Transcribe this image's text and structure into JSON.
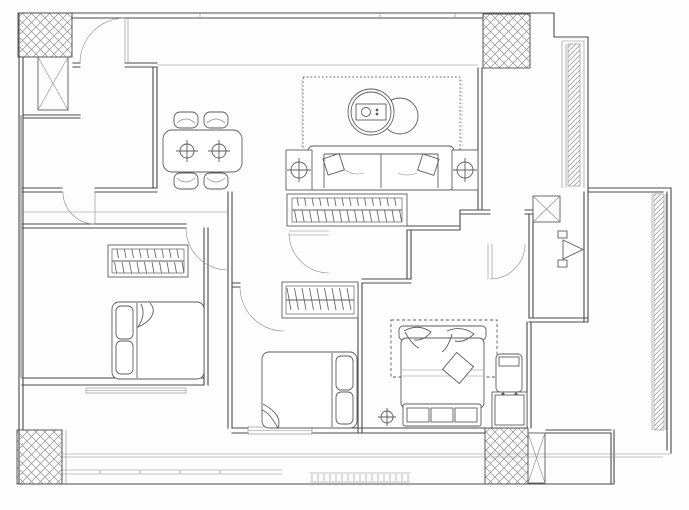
{
  "page": {
    "title": "Apartment Floor Plan (CAD line drawing)",
    "background": "#fdfdfd"
  },
  "colors": {
    "wall": "#4a4a4a",
    "thin": "#8b8b8b",
    "furn": "#5c5c5c",
    "hatch": "#909090",
    "bg": "#fdfdfd"
  },
  "elements": {
    "plan": {
      "label": "two-bedroom apartment floor plan, black line CAD drawing on white"
    },
    "structure": {
      "columns": {
        "label": "cross-hatched structural columns at four corners"
      },
      "shafts": {
        "label": "X-braced duct and shaft boxes"
      },
      "glass_strips": {
        "label": "diagonally hatched balcony parapet strips on right side"
      },
      "walls": {
        "label": "double-line interior and exterior walls"
      }
    },
    "rooms": {
      "kitchen": {
        "label": "kitchen room, top left"
      },
      "dining": {
        "label": "dining area with table for four"
      },
      "living": {
        "label": "living area with sofa and round tables"
      },
      "foyer": {
        "label": "entry strip, top right"
      },
      "bedroom_left": {
        "label": "left bedroom with double bed and wardrobe"
      },
      "bedroom_mid": {
        "label": "middle bedroom with double bed and wardrobe"
      },
      "master": {
        "label": "master bedroom with bed, bench and rug"
      },
      "bath": {
        "label": "bathroom with swing door"
      },
      "wc": {
        "label": "small WC with pivot door"
      },
      "terrace": {
        "label": "L-shaped terrace along right edge"
      },
      "balcony_south": {
        "label": "south balcony band with window rail and floor grate"
      }
    },
    "furniture": {
      "dining_table": {
        "label": "rounded rectangular dining table with two place settings"
      },
      "dining_chairs": {
        "label": "four dining chairs"
      },
      "rug": {
        "label": "dotted-border living room rug"
      },
      "coffee_tables": {
        "label": "two overlapping round coffee tables with tray"
      },
      "sofa": {
        "label": "three-seat sofa with throw pillows"
      },
      "side_tables": {
        "label": "two sofa side tables with crosshair lamps"
      },
      "pendants": {
        "label": "dotted pendant lamp drop lines"
      },
      "wardrobe_hall": {
        "label": "long hanger-rod wardrobe along hall"
      },
      "wardrobe_left": {
        "label": "left bedroom hanger-rod wardrobe"
      },
      "wardrobe_mid": {
        "label": "middle bedroom hanger-rod wardrobe"
      },
      "bed_left": {
        "label": "left bedroom double bed, pillows at west"
      },
      "bed_mid": {
        "label": "middle bedroom double bed, pillows at east"
      },
      "bed_master": {
        "label": "master double bed with scroll pillows and diamond cushion"
      },
      "bench": {
        "label": "three-cell bench at foot of master bed"
      },
      "cabinet": {
        "label": "two-knob nightstand cabinet"
      },
      "stool": {
        "label": "small stool beside cabinet"
      },
      "ceiling_lamp": {
        "label": "crosshair ceiling lamp symbol"
      },
      "grate": {
        "label": "comb-tooth floor grate at south balcony"
      }
    },
    "doors": {
      "door_north": {
        "label": "north service door with quarter-circle swing"
      },
      "door_kitchen": {
        "label": "kitchen door swing"
      },
      "door_bed_left": {
        "label": "left bedroom door swing"
      },
      "door_bed_mid": {
        "label": "middle bedroom door swing"
      },
      "door_master": {
        "label": "master bedroom door swing"
      },
      "door_bath": {
        "label": "bathroom door swing"
      },
      "door_wc": {
        "label": "WC pivot door triangle"
      }
    },
    "windows": {
      "label": "triple-line glazing on left wall and south windows"
    }
  }
}
